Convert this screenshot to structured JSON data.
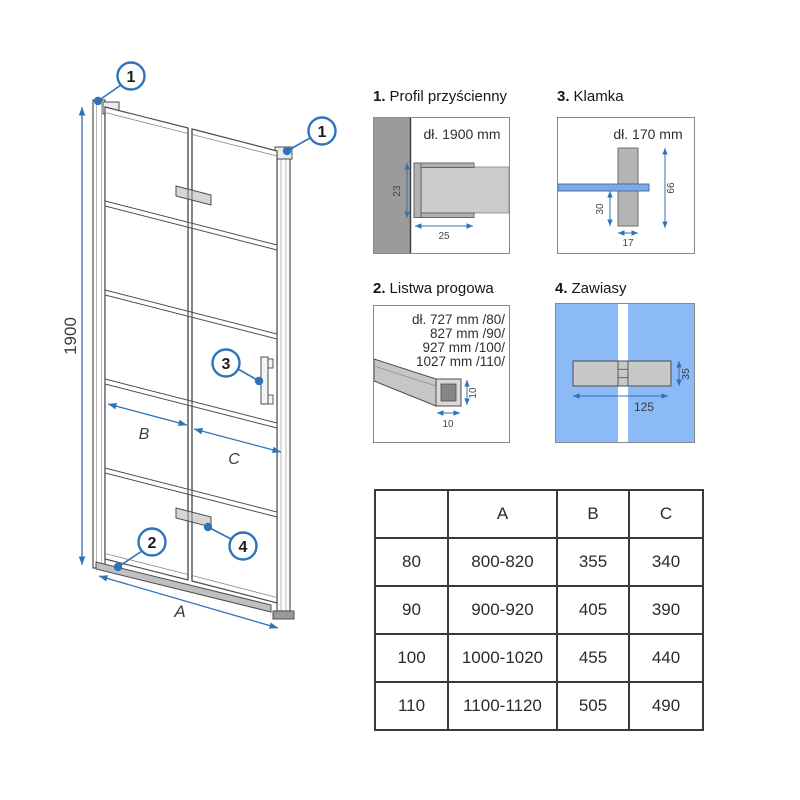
{
  "colors": {
    "accent_blue": "#2e73b8",
    "glass_blue": "#8cbaf7",
    "handle_glass_blue": "#7fa9e2",
    "wall_gray": "#9b9b9b",
    "part_gray": "#c6c6c6",
    "line_dark": "#4d4d4d"
  },
  "diagram": {
    "height_label": "1900",
    "total_width_label": "A",
    "left_door_label": "B",
    "right_door_label": "C",
    "callout_wall_profile_left": "1",
    "callout_wall_profile_right": "1",
    "callout_threshold": "2",
    "callout_handle": "3",
    "callout_hinge": "4"
  },
  "details": [
    {
      "number": "1.",
      "title": "Profil przyścienny",
      "length": "dł. 1900 mm",
      "dims": {
        "depth": "23",
        "width": "25"
      }
    },
    {
      "number": "2.",
      "title": "Listwa progowa",
      "lengths": [
        "dł. 727 mm /80/",
        "827 mm /90/",
        "927 mm /100/",
        "1027 mm /110/"
      ],
      "dims": {
        "height": "10",
        "width": "10"
      }
    },
    {
      "number": "3.",
      "title": "Klamka",
      "length": "dł. 170 mm",
      "dims": {
        "height": "66",
        "offset": "30",
        "width": "17"
      }
    },
    {
      "number": "4.",
      "title": "Zawiasy",
      "dims": {
        "length": "125",
        "height": "35"
      }
    }
  ],
  "size_table": {
    "headers": [
      "",
      "A",
      "B",
      "C"
    ],
    "rows": [
      [
        "80",
        "800-820",
        "355",
        "340"
      ],
      [
        "90",
        "900-920",
        "405",
        "390"
      ],
      [
        "100",
        "1000-1020",
        "455",
        "440"
      ],
      [
        "110",
        "1100-1120",
        "505",
        "490"
      ]
    ]
  }
}
